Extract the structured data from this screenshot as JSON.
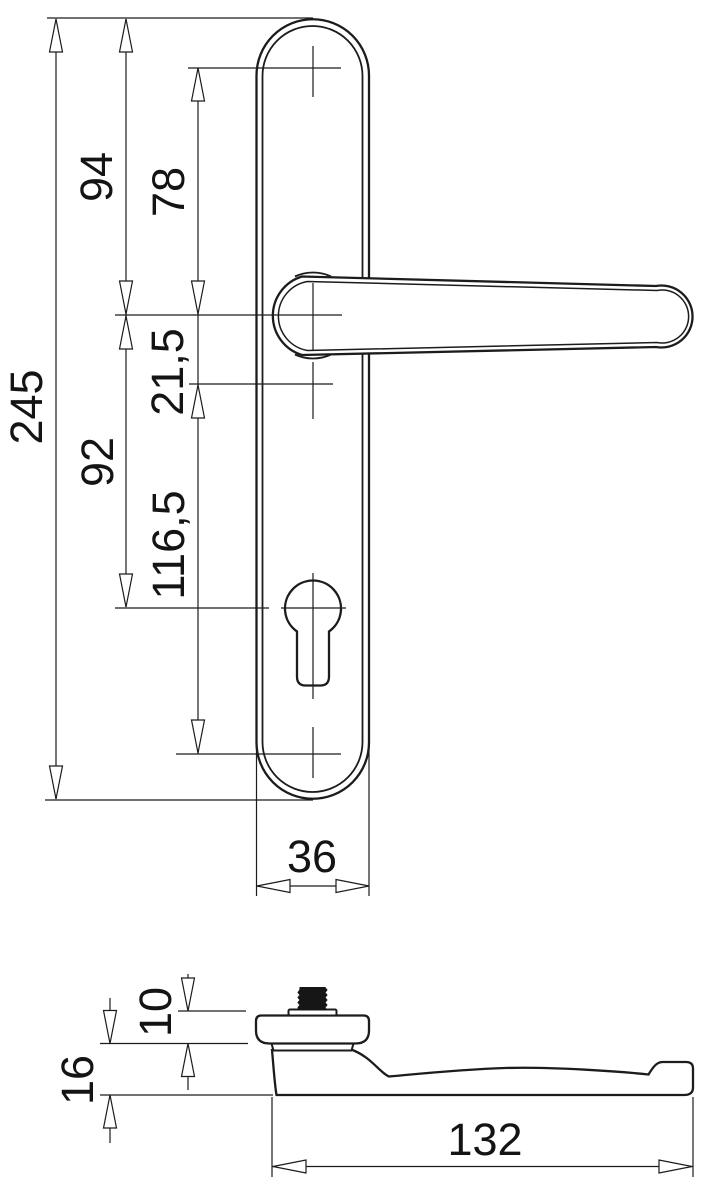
{
  "drawing": {
    "front_view": {
      "overall_height": "245",
      "plate_top_to_lever": "94",
      "top_hole_to_lever": "78",
      "lever_to_spindle": "21,5",
      "lever_to_cylinder": "92",
      "spindle_to_bottom_hole": "116,5",
      "plate_width": "36"
    },
    "side_view": {
      "rose_height": "10",
      "overall_depth": "16",
      "lever_length": "132"
    },
    "colors": {
      "line": "#1c1c1c",
      "background": "#ffffff"
    }
  }
}
